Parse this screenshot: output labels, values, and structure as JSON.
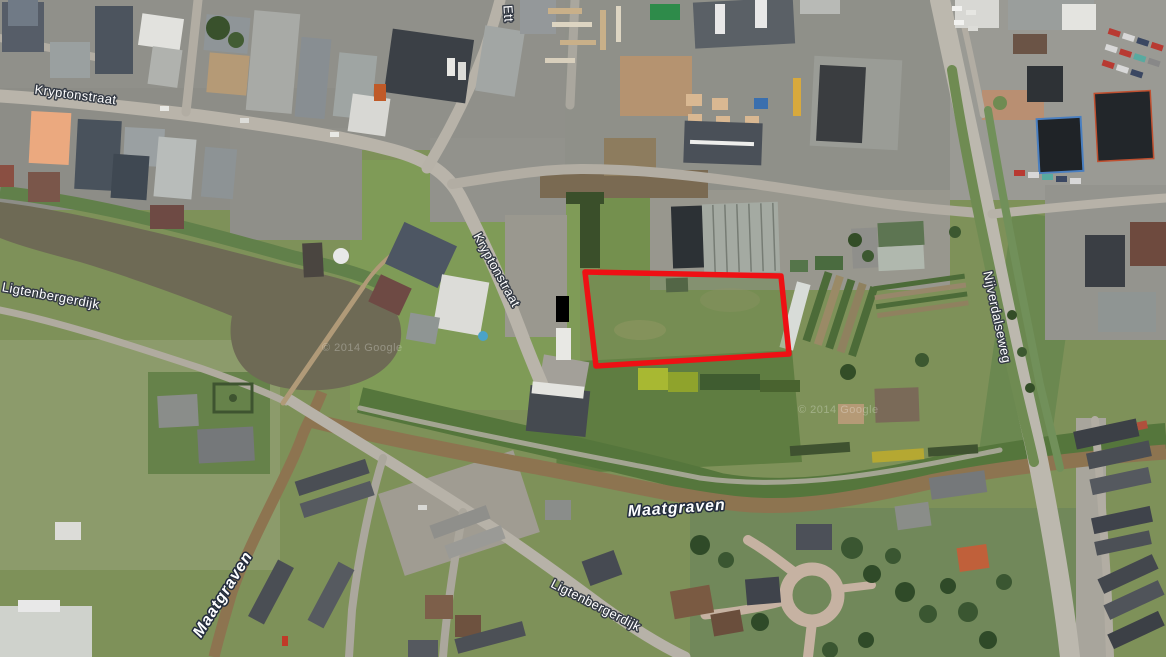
{
  "map": {
    "description": "satellite-aerial-view",
    "labels": [
      {
        "text": "Kryptonstraat",
        "kind": "road"
      },
      {
        "text": "Kryptonstraat",
        "kind": "road"
      },
      {
        "text": "Ligtenbergerdijk",
        "kind": "road"
      },
      {
        "text": "Nijverdalseweg",
        "kind": "road"
      },
      {
        "text": "Maatgraven",
        "kind": "water"
      },
      {
        "text": "Maatgraven",
        "kind": "water"
      },
      {
        "text": "Ligtenbergerdijk",
        "kind": "road"
      },
      {
        "text": "Ett",
        "kind": "road-partial"
      }
    ],
    "watermark": "© 2014 Google",
    "highlight_parcel": {
      "shape": "polygon",
      "points": "585,272 781,276 789,354 596,366",
      "stroke_color": "#ee1014",
      "stroke_width": 5.5
    },
    "colors": {
      "field_green": "#7e9159",
      "canal_water": "#6e6a55",
      "stream_water": "#8d7450",
      "road_gray": "#b7b2a8",
      "industrial_ground": "#90908a",
      "label_fill": "#ffffff"
    }
  }
}
